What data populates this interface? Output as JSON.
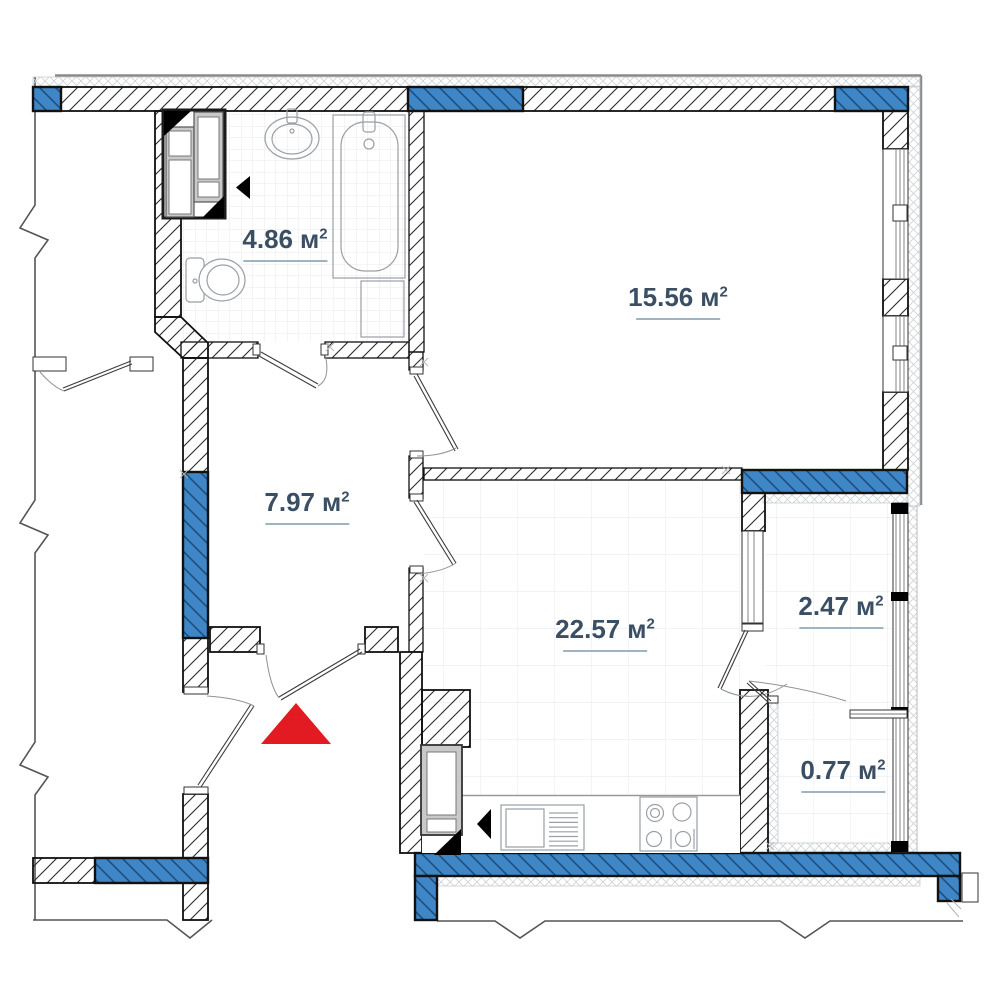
{
  "title": "apartment-floor-plan",
  "rooms": [
    {
      "id": "bathroom",
      "area": "4.86",
      "unit": "м",
      "power": "2"
    },
    {
      "id": "bedroom",
      "area": "15.56",
      "unit": "м",
      "power": "2"
    },
    {
      "id": "hallway",
      "area": "7.97",
      "unit": "м",
      "power": "2"
    },
    {
      "id": "kitchen-living",
      "area": "22.57",
      "unit": "м",
      "power": "2"
    },
    {
      "id": "loggia",
      "area": "2.47",
      "unit": "м",
      "power": "2"
    },
    {
      "id": "balcony",
      "area": "0.77",
      "unit": "м",
      "power": "2"
    }
  ],
  "icons": [
    {
      "name": "entrance-arrow",
      "meaning": "apartment entrance marker"
    },
    {
      "name": "direction-arrow-bathroom",
      "meaning": "black left arrow near shaft"
    },
    {
      "name": "direction-arrow-kitchen",
      "meaning": "black left arrow near boiler"
    }
  ],
  "theme": {
    "window_fill": "#3E86C6",
    "window_hatch": "#1B4E7F",
    "wall_stroke": "#111111",
    "wall_hatch": "#2a2a2a",
    "insulation": "#cdd2d6",
    "grid_small": "#e9eaec",
    "grid_large": "#e8edf1",
    "fixture": "#9aa0a6",
    "shaft_gray": "#c9c9c9",
    "entrance_marker": "#E21B23",
    "icon_black": "#000000",
    "label_text": "#3A4F63",
    "label_underline": "#9FB3C0",
    "outer_line": "#8A8A8A",
    "break_line": "#555555"
  }
}
